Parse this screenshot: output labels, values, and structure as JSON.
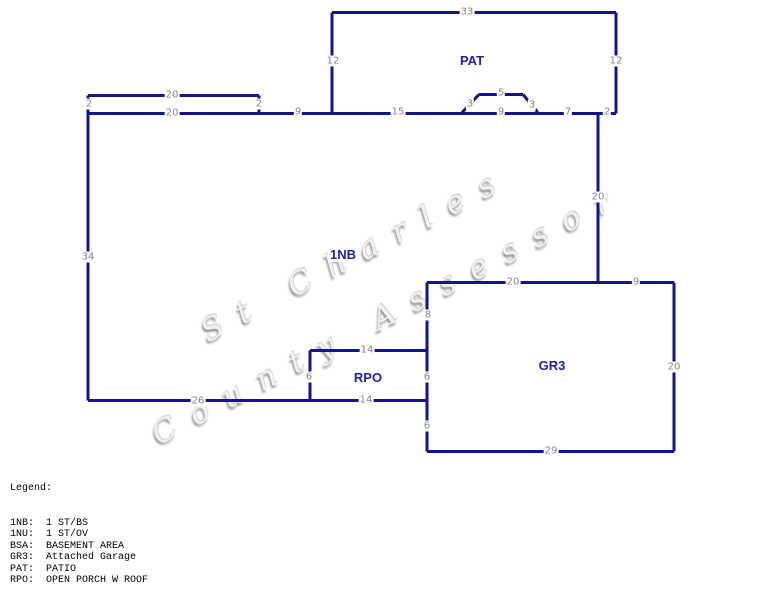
{
  "watermark": {
    "line1": "St Charles",
    "line2": "County Assessor"
  },
  "colors": {
    "outline": "#14148c",
    "dimension_text": "#858585",
    "area_text": "#2121a6",
    "legend_text": "#000000",
    "watermark_text": "#919191",
    "background": "#ffffff"
  },
  "sketch": {
    "segments": [
      {
        "part": "patio",
        "x1": 332,
        "y1": 12,
        "x2": 616,
        "y2": 12
      },
      {
        "part": "patio",
        "x1": 332,
        "y1": 12,
        "x2": 332,
        "y2": 113
      },
      {
        "part": "patio",
        "x1": 616,
        "y1": 12,
        "x2": 616,
        "y2": 113
      },
      {
        "part": "front-strip",
        "x1": 88,
        "y1": 95,
        "x2": 259,
        "y2": 95
      },
      {
        "part": "front-strip",
        "x1": 88,
        "y1": 95,
        "x2": 88,
        "y2": 113
      },
      {
        "part": "front-strip",
        "x1": 259,
        "y1": 95,
        "x2": 259,
        "y2": 113
      },
      {
        "part": "main-house",
        "x1": 88,
        "y1": 113,
        "x2": 616,
        "y2": 113
      },
      {
        "part": "main-house",
        "x1": 88,
        "y1": 113,
        "x2": 88,
        "y2": 400
      },
      {
        "part": "main-house",
        "x1": 88,
        "y1": 400,
        "x2": 427,
        "y2": 400
      },
      {
        "part": "main-house",
        "x1": 598,
        "y1": 113,
        "x2": 598,
        "y2": 282
      },
      {
        "part": "entry-step",
        "x1": 462,
        "y1": 112,
        "x2": 479,
        "y2": 94
      },
      {
        "part": "entry-step",
        "x1": 479,
        "y1": 94,
        "x2": 523,
        "y2": 94
      },
      {
        "part": "entry-step",
        "x1": 523,
        "y1": 94,
        "x2": 538,
        "y2": 112
      },
      {
        "part": "garage",
        "x1": 427,
        "y1": 282,
        "x2": 674,
        "y2": 282
      },
      {
        "part": "garage",
        "x1": 427,
        "y1": 282,
        "x2": 427,
        "y2": 451
      },
      {
        "part": "garage",
        "x1": 674,
        "y1": 282,
        "x2": 674,
        "y2": 451
      },
      {
        "part": "garage",
        "x1": 427,
        "y1": 451,
        "x2": 674,
        "y2": 451
      },
      {
        "part": "porch",
        "x1": 310,
        "y1": 350,
        "x2": 427,
        "y2": 350
      },
      {
        "part": "porch",
        "x1": 310,
        "y1": 350,
        "x2": 310,
        "y2": 400
      }
    ],
    "dimensions": [
      {
        "t": "33",
        "x": 467,
        "y": 12
      },
      {
        "t": "12",
        "x": 333,
        "y": 61
      },
      {
        "t": "12",
        "x": 616,
        "y": 61
      },
      {
        "t": "20",
        "x": 172,
        "y": 95
      },
      {
        "t": "2",
        "x": 89,
        "y": 104
      },
      {
        "t": "2",
        "x": 259,
        "y": 104
      },
      {
        "t": "20",
        "x": 172,
        "y": 113
      },
      {
        "t": "9",
        "x": 298,
        "y": 112
      },
      {
        "t": "15",
        "x": 398,
        "y": 112
      },
      {
        "t": "3",
        "x": 470,
        "y": 104
      },
      {
        "t": "5",
        "x": 501,
        "y": 93
      },
      {
        "t": "3",
        "x": 532,
        "y": 105
      },
      {
        "t": "9",
        "x": 501,
        "y": 112
      },
      {
        "t": "7",
        "x": 568,
        "y": 112
      },
      {
        "t": "2",
        "x": 607,
        "y": 112
      },
      {
        "t": "34",
        "x": 88,
        "y": 257
      },
      {
        "t": "20",
        "x": 598,
        "y": 197
      },
      {
        "t": "20",
        "x": 513,
        "y": 282
      },
      {
        "t": "9",
        "x": 636,
        "y": 282
      },
      {
        "t": "8",
        "x": 428,
        "y": 315
      },
      {
        "t": "14",
        "x": 367,
        "y": 350
      },
      {
        "t": "6",
        "x": 309,
        "y": 377
      },
      {
        "t": "6",
        "x": 427,
        "y": 377
      },
      {
        "t": "20",
        "x": 674,
        "y": 367
      },
      {
        "t": "26",
        "x": 198,
        "y": 401
      },
      {
        "t": "14",
        "x": 366,
        "y": 400
      },
      {
        "t": "6",
        "x": 427,
        "y": 426
      },
      {
        "t": "29",
        "x": 551,
        "y": 451
      }
    ],
    "areas": [
      {
        "t": "PAT",
        "x": 472,
        "y": 61
      },
      {
        "t": "1NB",
        "x": 343,
        "y": 255
      },
      {
        "t": "RPO",
        "x": 368,
        "y": 378
      },
      {
        "t": "GR3",
        "x": 552,
        "y": 366
      }
    ]
  },
  "legend": {
    "title": "Legend:",
    "entries": [
      {
        "code": "1NB:",
        "desc": "1 ST/BS"
      },
      {
        "code": "1NU:",
        "desc": "1 ST/OV"
      },
      {
        "code": "BSA:",
        "desc": "BASEMENT AREA"
      },
      {
        "code": "GR3:",
        "desc": "Attached Garage"
      },
      {
        "code": "PAT:",
        "desc": "PATIO"
      },
      {
        "code": "RPO:",
        "desc": "OPEN PORCH W ROOF"
      }
    ]
  }
}
